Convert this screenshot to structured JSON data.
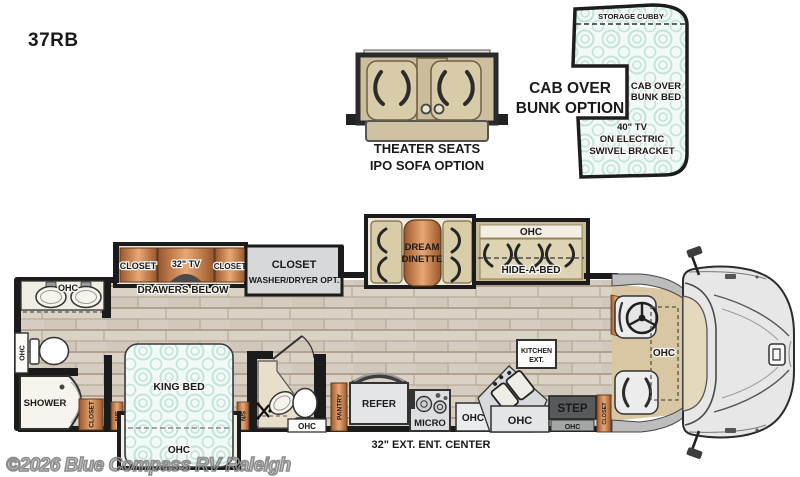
{
  "model": "37RB",
  "watermark": "©2026 Blue Compass RV Raleigh",
  "theater": {
    "line1": "THEATER SEATS",
    "line2": "IPO SOFA OPTION"
  },
  "bunk": {
    "option1": "CAB OVER",
    "option2": "BUNK OPTION",
    "storage": "STORAGE CUBBY",
    "bed1": "CAB OVER",
    "bed2": "BUNK BED",
    "tv1": "40\" TV",
    "tv2": "ON ELECTRIC",
    "tv3": "SWIVEL BRACKET"
  },
  "bath": {
    "vanity_ohc": "OHC",
    "toilet_ohc": "OHC",
    "shower": "SHOWER",
    "closet": "CLOSET"
  },
  "bedroom": {
    "king": "KING BED",
    "ohc": "OHC",
    "ns_left": "N/S",
    "ns_right": "N/S"
  },
  "slide1": {
    "closet1": "CLOSET",
    "tv": "32\" TV",
    "closet2": "CLOSET",
    "drawers": "DRAWERS BELOW"
  },
  "wd": {
    "line1": "CLOSET",
    "line2": "WASHER/DRYER OPT."
  },
  "dinette": {
    "line1": "DREAM",
    "line2": "DINETTE"
  },
  "hab": {
    "ohc": "OHC",
    "label": "HIDE-A-BED"
  },
  "halfbath": {
    "ohc": "OHC"
  },
  "kitchen": {
    "pantry": "PANTRY",
    "refer": "REFER",
    "micro": "MICRO",
    "ohc1": "OHC",
    "ohc2": "OHC",
    "ext1": "KITCHEN",
    "ext2": "EXT.",
    "step": "STEP",
    "step_ohc": "OHC",
    "closet": "CLOSET",
    "ent_center": "32\" EXT. ENT. CENTER"
  },
  "cab": {
    "ohc": "OHC"
  },
  "colors": {
    "copper": "#c8804e",
    "mint": "#c3e3d9",
    "wall": "#1b1b1b",
    "floor": "#d9d2c5",
    "tan": "#d5c8a6"
  }
}
